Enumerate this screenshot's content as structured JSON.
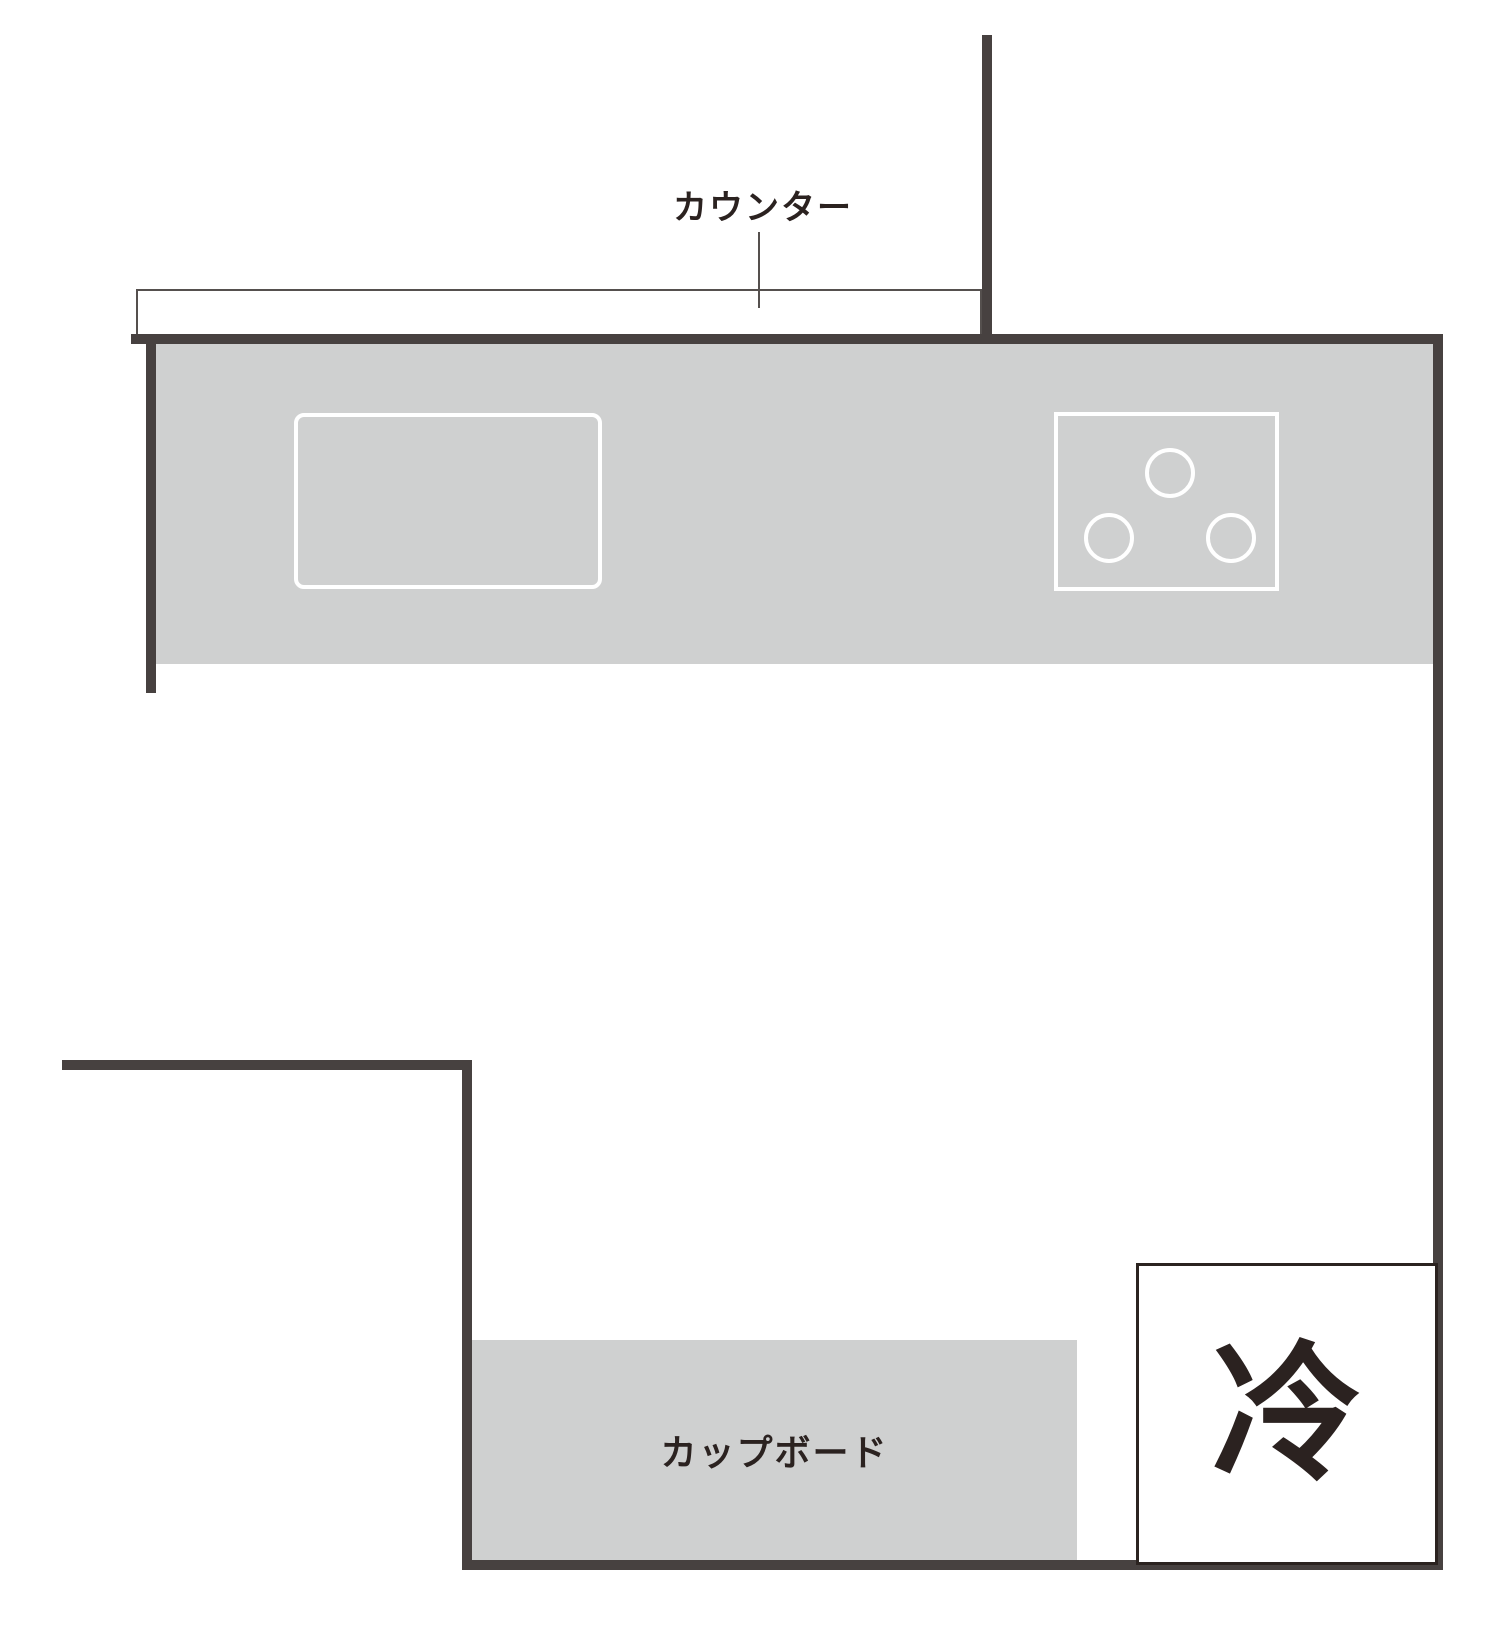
{
  "diagram": {
    "type": "kitchen-floor-plan"
  },
  "labels": {
    "counter": "カウンター",
    "cupboard": "カップボード",
    "refrigerator": "冷"
  },
  "colors": {
    "background": "#ffffff",
    "wall": "#474140",
    "fixture_fill": "#cfd0d0",
    "outline_white": "#ffffff",
    "thin_line": "#55504e",
    "fridge_border": "#2b2320",
    "text": "#2b2220"
  }
}
